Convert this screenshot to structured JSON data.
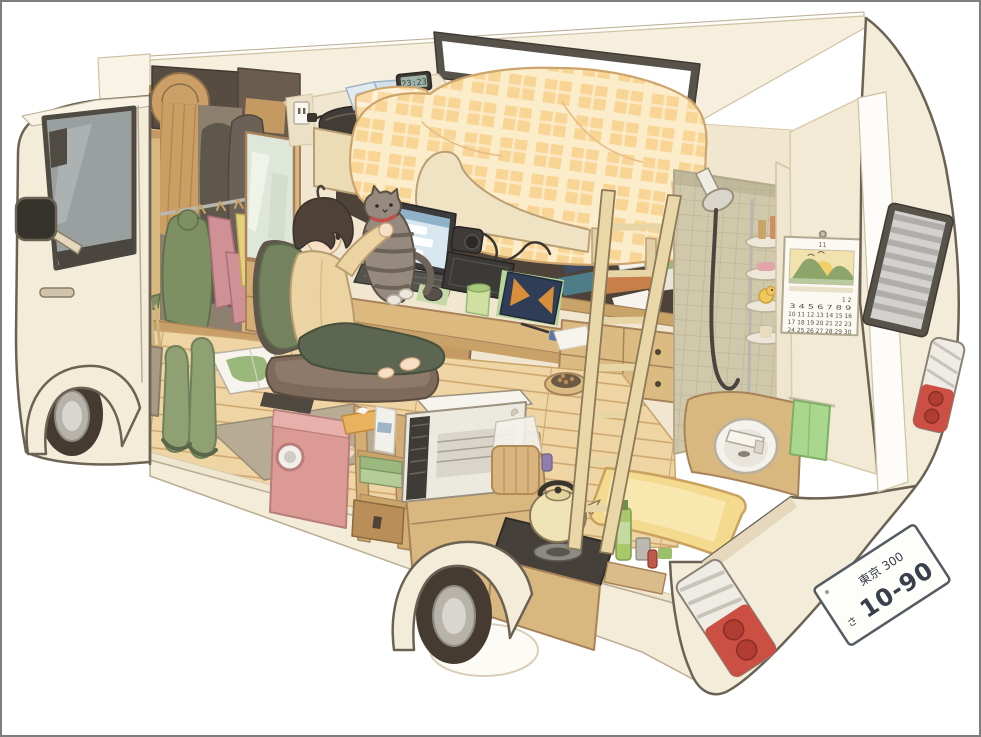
{
  "scene": {
    "description": "Anime-style cutaway illustration of a camper van: a person on a floor chair lifts a grey tabby cat beside a desk with a laptop, under a loft bed with an orange plaid comforter. The van interior also holds a wardrobe with hanging clothes, a washing machine, shelves, a microwave cart, a kettle on a gas stove, a yellow bathtub, a round sink, a tiled shower with a rubber duck, a wall calendar, a ladder, rain boots and a road map. Exterior shows the cab, wheels, rear vent window, tail lights and a license plate.",
    "background_color": "#ffffff",
    "border_color": "#7e7e7e"
  },
  "clock": {
    "time": "23:23"
  },
  "license_plate": {
    "top_line": "東京 300",
    "kana": "さ",
    "number": "10-90"
  },
  "calendar": {
    "month": "11",
    "rows": [
      "1 2",
      "3 4 5 6 7 8 9",
      "10 11 12 13 14 15 16",
      "17 18 19 20 21 22 23",
      "24 25 26 27 28 29 30"
    ]
  },
  "objects": [
    "loft bed",
    "plaid comforter",
    "wooden ladder",
    "laptop",
    "tabby cat",
    "floor chair",
    "wardrobe with clothes",
    "washing machine",
    "microwave",
    "bread bag",
    "kettle",
    "gas stove",
    "bathtub",
    "round sink",
    "shower head",
    "corner shelf",
    "rubber duck",
    "green towel",
    "wall calendar",
    "rear vent window",
    "tail lights",
    "license plate",
    "rain boots",
    "sneakers",
    "road map",
    "pet food bowl",
    "umbrella stand",
    "digital clock",
    "open book",
    "power outlet"
  ],
  "palette": {
    "body": "#f3ecd9",
    "body_shadow": "#e5d8bc",
    "outline": "#6c6254",
    "roof": "#f6efde",
    "window_frame": "#57524a",
    "glass": "#9aa0a0",
    "interior_wall": "#f1e7d0",
    "wood": "#d9b87f",
    "wood_dark": "#c29a62",
    "floor": "#eed5a3",
    "comforter": "#f7d89d",
    "comforter_light": "#fcedca",
    "bed_frame": "#ecdcb6",
    "alcove": "#4d4339",
    "tire": "#453b31",
    "hub": "#b7b3ab",
    "hair": "#4e4137",
    "skin": "#f6dfc5",
    "cardigan": "#ecd3a2",
    "pants": "#5d6650",
    "jacket": "#75825f",
    "chair": "#7e6a5b",
    "cat": "#968a7f",
    "cat_stripe": "#675d51",
    "washer_pink": "#dc9a95",
    "boots_green": "#8fa173",
    "towel_green": "#a9d78d",
    "tub_yellow": "#f4da8e",
    "stove_dark": "#45403a",
    "kettle_cream": "#f0e3b6",
    "tile": "#d0c8ab",
    "tail_red": "#cb4f43",
    "plate_text": "#39404c",
    "screen_blue": "#d8e7ef"
  }
}
